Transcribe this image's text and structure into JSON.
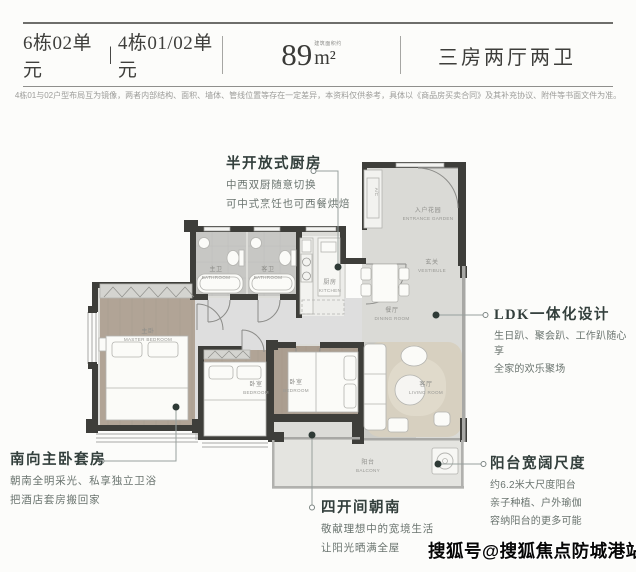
{
  "header": {
    "unit_left": "6栋02单元",
    "separator": "|",
    "unit_right": "4栋01/02单元",
    "area_value": "89",
    "area_prefix": "建筑面积约",
    "area_unit": "m²",
    "layout": "三房两厅两卫"
  },
  "disclaimer": "4栋01与02户型布局互为镜像，两者内部结构、面积、墙体、管线位置等存在一定差异，本资料仅供参考，具体以《商品房买卖合同》及其补充协议、附件等书面文件为准。",
  "annotations": {
    "kitchen": {
      "title": "半开放式厨房",
      "line1": "中西双厨随意切换",
      "line2": "可中式烹饪也可西餐烘焙"
    },
    "ldk": {
      "title": "LDK一体化设计",
      "line1": "生日趴、聚会趴、工作趴随心享",
      "line2": "全家的欢乐聚场"
    },
    "master": {
      "title": "南向主卧套房",
      "line1": "朝南全明采光、私享独立卫浴",
      "line2": "把酒店套房搬回家"
    },
    "south": {
      "title": "四开间朝南",
      "line1": "敬献理想中的宽境生活",
      "line2": "让阳光晒满全屋"
    },
    "balcony": {
      "title": "阳台宽阔尺度",
      "line1": "约6.2米大尺度阳台",
      "line2": "亲子种植、户外瑜伽",
      "line3": "容纳阳台的更多可能"
    }
  },
  "rooms": {
    "master": {
      "cn": "主卧",
      "en": "MASTER BEDROOM"
    },
    "bath1": {
      "cn": "主卫",
      "en": "BATHROOM"
    },
    "bath2": {
      "cn": "客卫",
      "en": "BATHROOM"
    },
    "kitchen": {
      "cn": "厨房",
      "en": "KITCHEN"
    },
    "entrance": {
      "cn": "入户花园",
      "en": "ENTRANCE GARDEN"
    },
    "vestibule": {
      "cn": "玄关",
      "en": "VESTIBULE"
    },
    "dining": {
      "cn": "餐厅",
      "en": "DINING ROOM"
    },
    "bedroom2": {
      "cn": "卧室",
      "en": "BEDROOM"
    },
    "bedroom3": {
      "cn": "卧室",
      "en": "BEDROOM"
    },
    "living": {
      "cn": "客厅",
      "en": "LIVING ROOM"
    },
    "balcony": {
      "cn": "阳台",
      "en": "BALCONY"
    },
    "ac": "A/C"
  },
  "watermark": "搜狐号@搜狐焦点防城港站",
  "colors": {
    "wall": "#3e3e3a",
    "hall_floor": "#dcdcd8",
    "wood_floor": "#b1a496",
    "tile_floor": "#c7c7c4",
    "rug_beige": "#d7d0c0",
    "annotation_title": "#333f3c",
    "annotation_body": "#6a746f",
    "leader": "#97a09d"
  }
}
